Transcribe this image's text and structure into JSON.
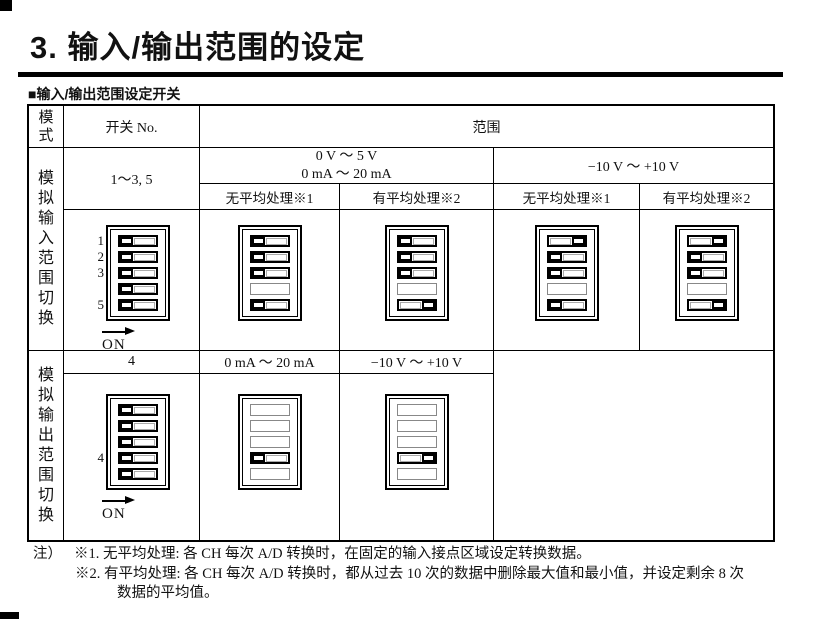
{
  "page": {
    "title": "3. 输入/输出范围的设定",
    "section_heading": "■输入/输出范围设定开关"
  },
  "table": {
    "header": {
      "mode": "模式",
      "switch_no": "开关 No.",
      "range": "范围"
    },
    "input_band": {
      "mode_label": "模拟输入范围切换",
      "switch_no": "1～3, 5",
      "range_low_line1": "0 V ～ 5 V",
      "range_low_line2": "0 mA ～ 20 mA",
      "range_high": "−10 V ～ +10 V",
      "subheaders": [
        "无平均处理※1",
        "有平均处理※2",
        "无平均处理※1",
        "有平均处理※2"
      ]
    },
    "output_band": {
      "mode_label": "模拟输出范围切换",
      "switch_no": "4",
      "range_current": "0 mA ～ 20 mA",
      "range_voltage": "−10 V ～ +10 V"
    }
  },
  "dip_on_label": "ON",
  "dip_legend": {
    "L": "off(left)",
    "R": "on(right)",
    "-": "not-drawn"
  },
  "dips": {
    "input_reference": {
      "labels": [
        "1",
        "2",
        "3",
        "",
        "5"
      ],
      "slots": [
        "L",
        "L",
        "L",
        "L",
        "L"
      ],
      "arrow": true
    },
    "input_0v_5v_no_avg": {
      "slots": [
        "L",
        "L",
        "L",
        "-",
        "L"
      ]
    },
    "input_0v_5v_avg": {
      "slots": [
        "L",
        "L",
        "L",
        "-",
        "R"
      ]
    },
    "input_pm10v_no_avg": {
      "slots": [
        "R",
        "L",
        "L",
        "-",
        "L"
      ]
    },
    "input_pm10v_avg": {
      "slots": [
        "R",
        "L",
        "L",
        "-",
        "R"
      ]
    },
    "output_reference": {
      "labels": [
        "",
        "",
        "",
        "4",
        ""
      ],
      "slots": [
        "L",
        "L",
        "L",
        "L",
        "L"
      ],
      "arrow": true
    },
    "output_0ma_20ma": {
      "slots": [
        "-",
        "-",
        "-",
        "L",
        "-"
      ]
    },
    "output_pm10v": {
      "slots": [
        "-",
        "-",
        "-",
        "R",
        "-"
      ]
    }
  },
  "notes": {
    "prefix": "注）",
    "line1": "※1. 无平均处理: 各 CH 每次 A/D 转换时，在固定的输入接点区域设定转换数据。",
    "line2": "※2. 有平均处理: 各 CH 每次 A/D 转换时，都从过去 10 次的数据中删除最大值和最小值，并设定剩余 8 次",
    "line3": "数据的平均值。"
  }
}
